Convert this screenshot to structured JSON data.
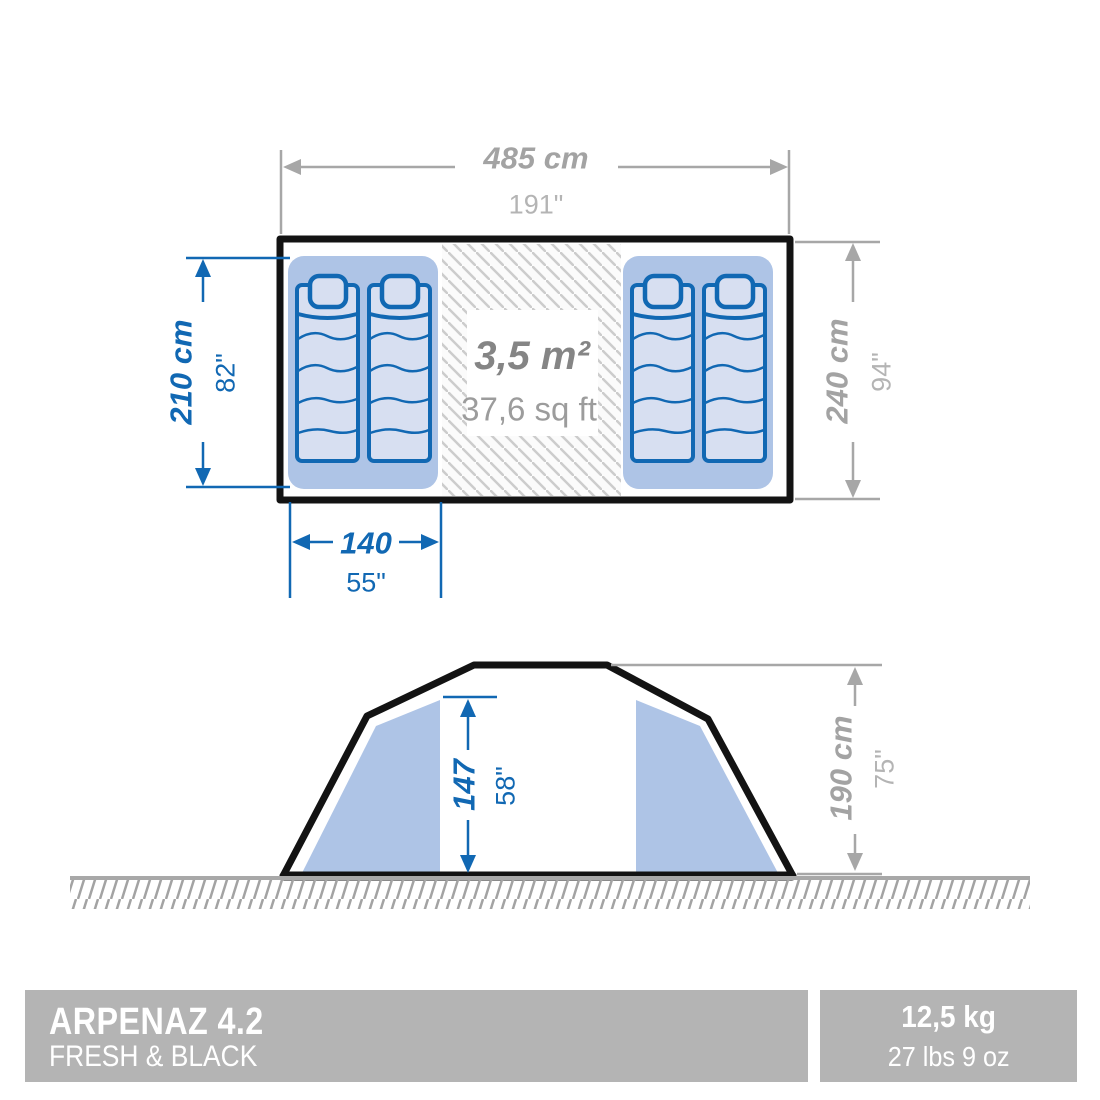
{
  "title": "Tent dimensions diagram",
  "colors": {
    "blue": "#1168b3",
    "gray": "#a7a7a7",
    "gray_text": "#a3a3a3",
    "gray_light": "#b4b4b4",
    "panel_blue": "#aec4e6",
    "pad_fill": "#d7dff1",
    "bar_gray": "#b4b4b4",
    "hatch_gray": "#cccccc",
    "ink": "#131313"
  },
  "floor_plan": {
    "width": {
      "cm": "485 cm",
      "in": "191\""
    },
    "bedroom_depth": {
      "cm": "210 cm",
      "in": "82\""
    },
    "outer_depth": {
      "cm": "240 cm",
      "in": "94\""
    },
    "bed_width": {
      "cm": "140",
      "in": "55\""
    },
    "living_area": {
      "m2": "3,5 m²",
      "sqft": "37,6 sq ft"
    }
  },
  "elevation": {
    "inner_height": {
      "cm": "147",
      "in": "58\""
    },
    "outer_height": {
      "cm": "190 cm",
      "in": "75\""
    }
  },
  "footer": {
    "product_name": "ARPENAZ 4.2",
    "product_line": "FRESH & BLACK",
    "weight_kg": "12,5 kg",
    "weight_lbs": "27 lbs 9 oz"
  }
}
